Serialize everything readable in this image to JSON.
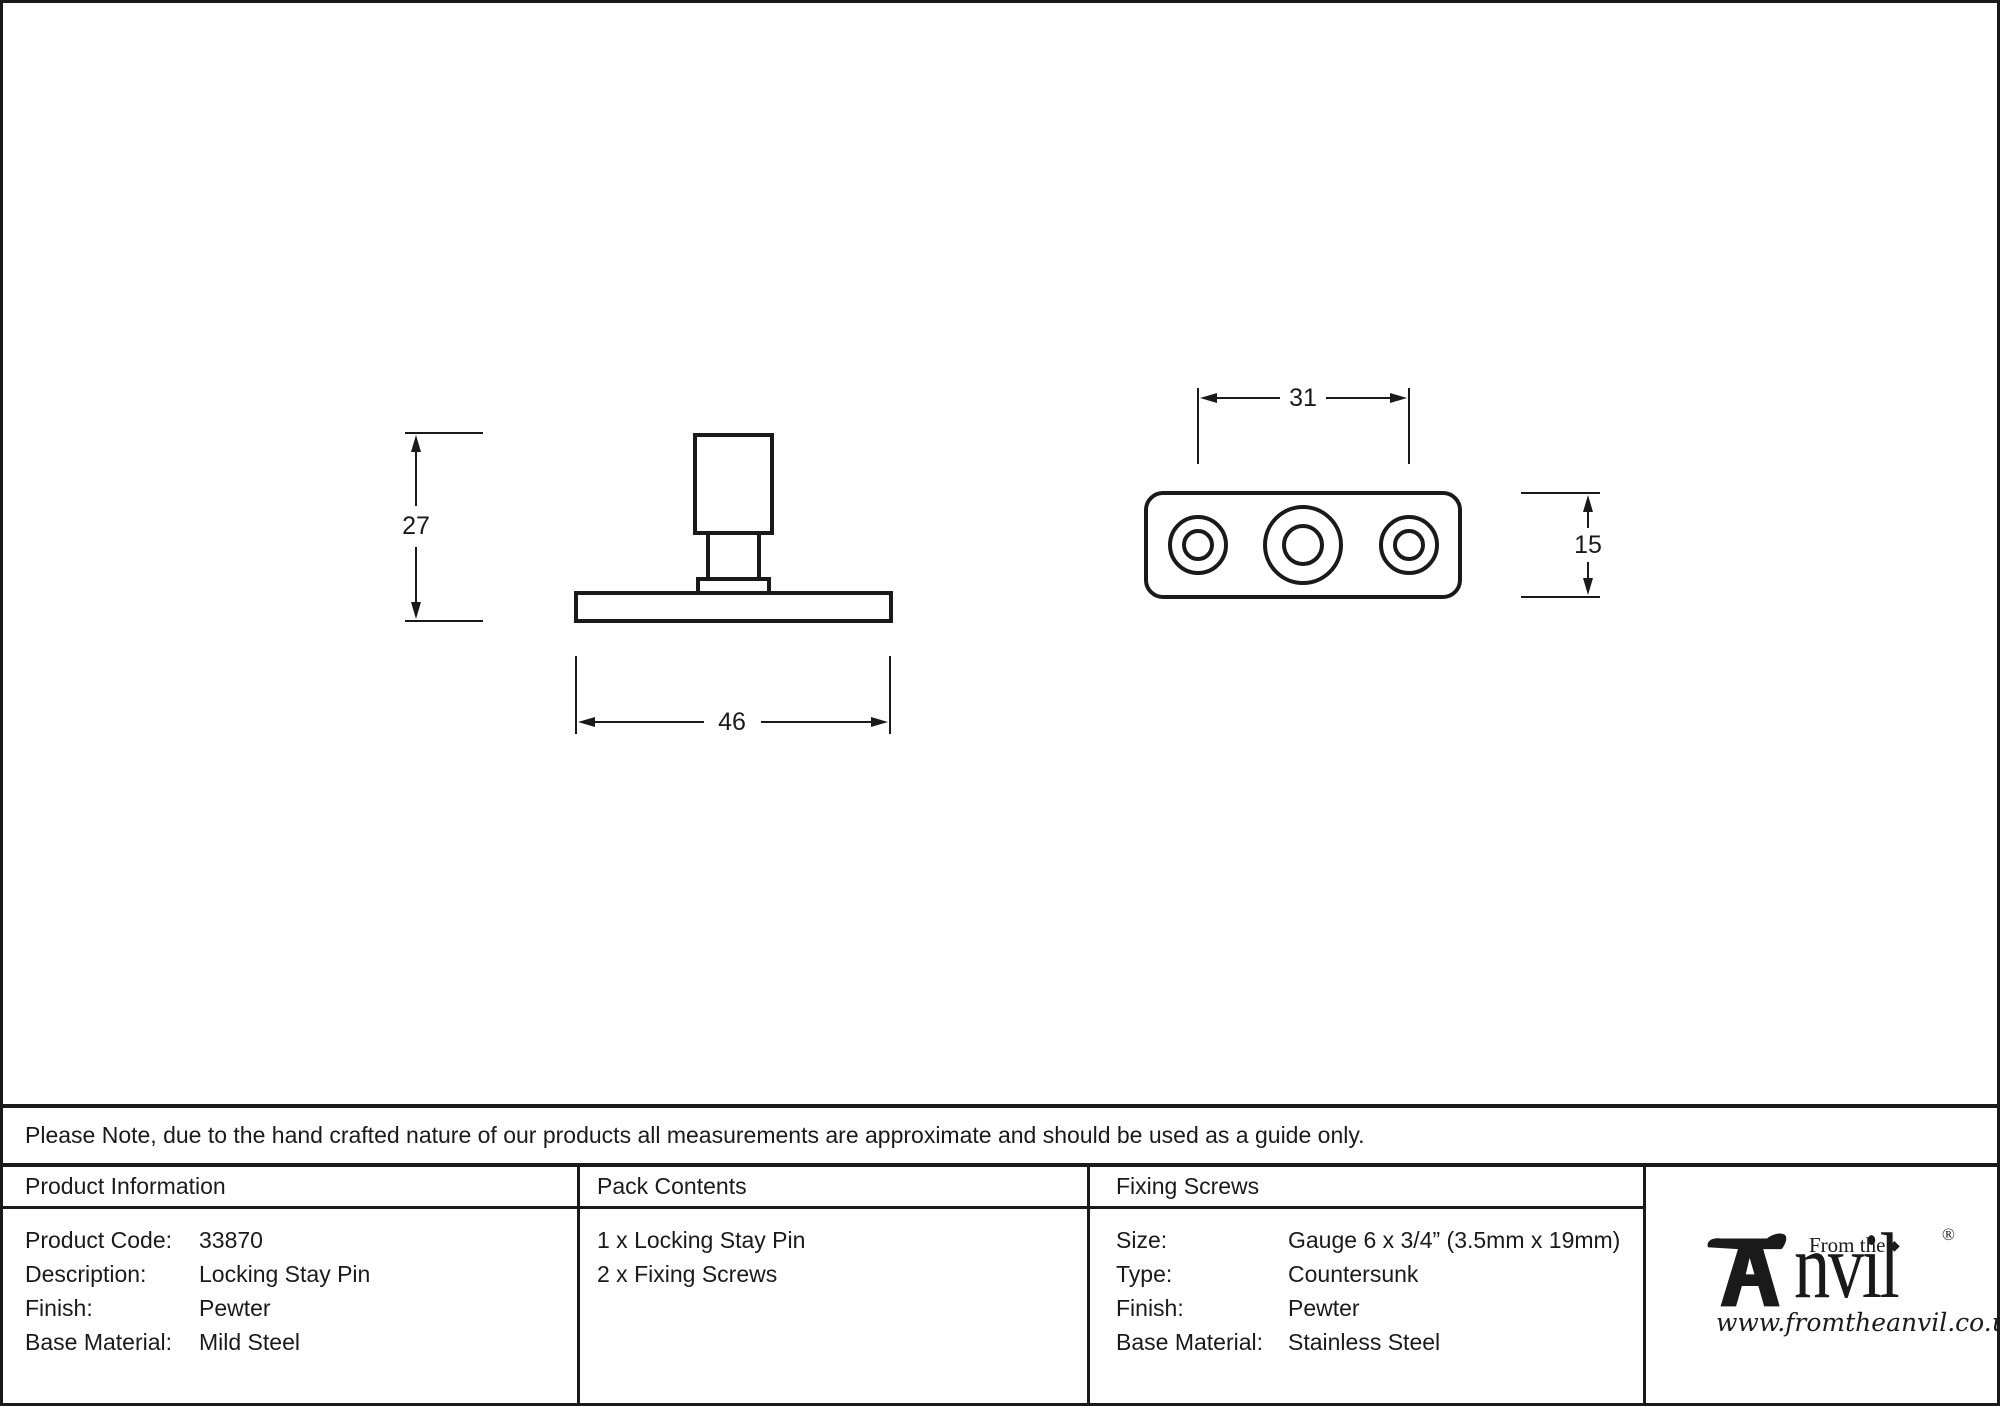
{
  "note": "Please Note, due to the hand crafted nature of our products all measurements are approximate and should be used as a guide only.",
  "drawing": {
    "side_view": {
      "height_dim": "27",
      "width_dim": "46"
    },
    "top_view": {
      "width_dim": "31",
      "height_dim": "15"
    }
  },
  "table": {
    "product_information": {
      "header": "Product Information",
      "rows": [
        {
          "label": "Product Code:",
          "value": "33870"
        },
        {
          "label": "Description:",
          "value": "Locking Stay Pin"
        },
        {
          "label": "Finish:",
          "value": "Pewter"
        },
        {
          "label": "Base Material:",
          "value": "Mild Steel"
        }
      ]
    },
    "pack_contents": {
      "header": "Pack Contents",
      "items": [
        "1 x Locking Stay Pin",
        "2 x Fixing Screws"
      ]
    },
    "fixing_screws": {
      "header": "Fixing Screws",
      "rows": [
        {
          "label": "Size:",
          "value": "Gauge 6 x 3/4” (3.5mm x 19mm)"
        },
        {
          "label": "Type:",
          "value": "Countersunk"
        },
        {
          "label": "Finish:",
          "value": "Pewter"
        },
        {
          "label": "Base Material:",
          "value": "Stainless Steel"
        }
      ]
    }
  },
  "logo": {
    "from_the": "From the",
    "brand": "nvil",
    "registered": "®",
    "diamond": "◆",
    "website": "www.fromtheanvil.co.uk"
  },
  "colors": {
    "ink": "#1a1a1a",
    "background": "#ffffff"
  }
}
